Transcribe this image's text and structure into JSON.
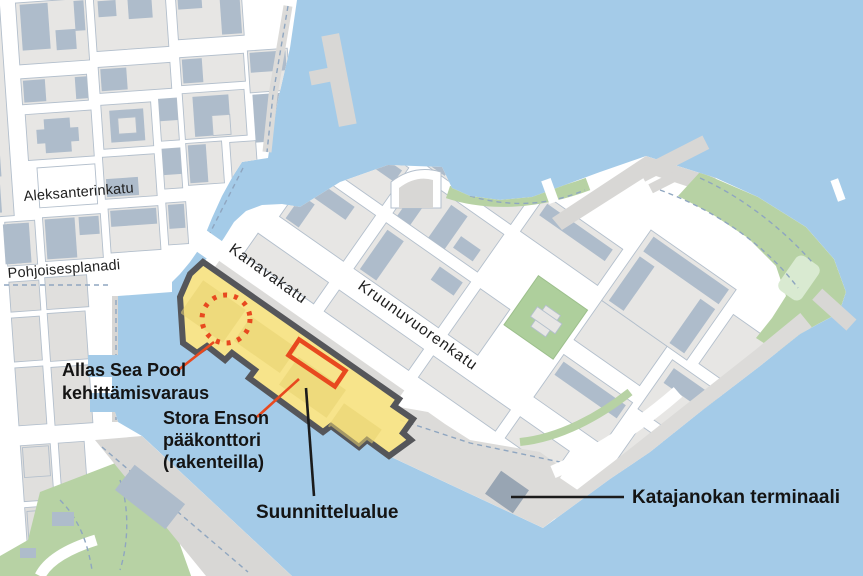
{
  "map": {
    "street_labels": [
      {
        "id": "aleksanterinkatu",
        "text": "Aleksanterinkatu"
      },
      {
        "id": "pohjoisesplanadi",
        "text": "Pohjoisesplanadi"
      },
      {
        "id": "kanavakatu",
        "text": "Kanavakatu"
      },
      {
        "id": "kruunuvuorenkatu",
        "text": "Kruunuvuorenkatu"
      }
    ],
    "annotations": {
      "allas": {
        "line1": "Allas Sea Pool",
        "line2": "kehittämisvaraus",
        "marker": "dotted-circle"
      },
      "stora": {
        "line1": "Stora Enson",
        "line2": "pääkonttori",
        "line3": "(rakenteilla)",
        "marker": "red-rectangle"
      },
      "plan_area": {
        "label": "Suunnittelualue",
        "marker": "yellow-area"
      },
      "terminal": {
        "label": "Katajanokan terminaali",
        "marker": "terminal-building"
      }
    },
    "colors": {
      "water": "#a4cbe8",
      "land": "#ffffff",
      "block": "#e7e6e4",
      "building": "#aebccb",
      "park": "#b7d2a4",
      "quay": "#d8d7d5",
      "planning_area_fill": "#f7e284",
      "planning_area_outline": "#55565a",
      "marker_red": "#e8491f",
      "leader_black": "#1b1b1b"
    }
  }
}
